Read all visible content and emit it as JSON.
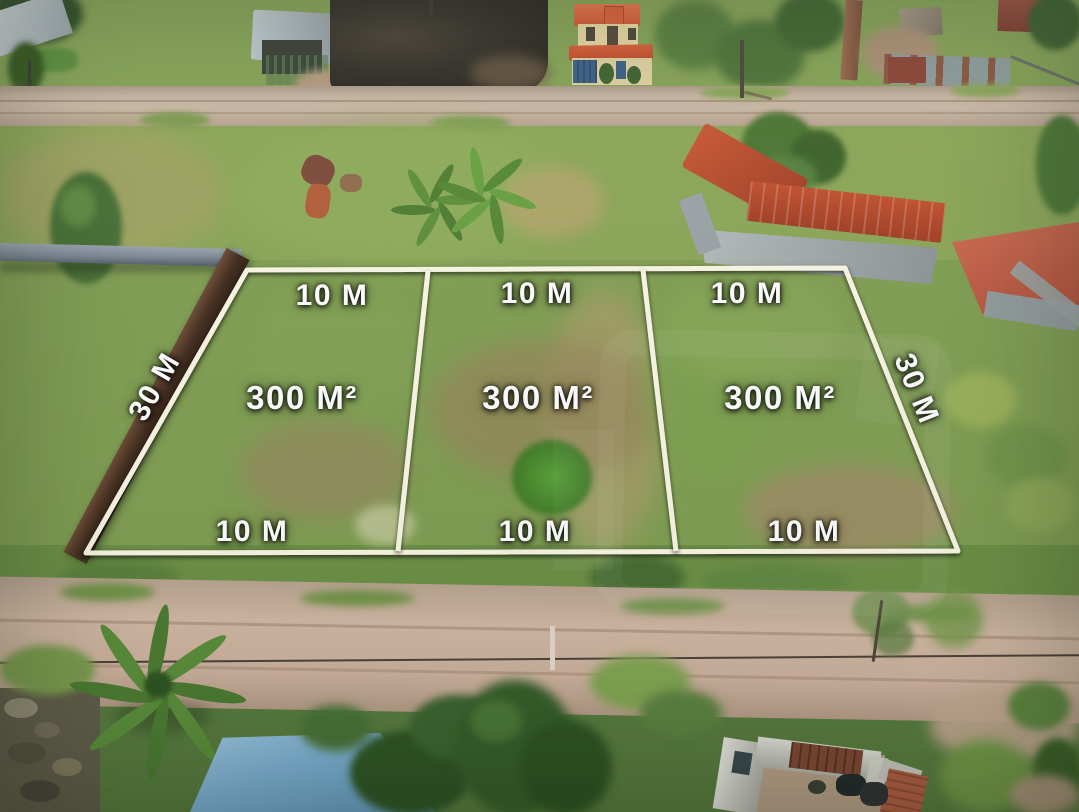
{
  "image_type": "aerial-drone-photo-of-land-plots",
  "overlay": {
    "line_color": "#fbf7e6",
    "label_color": "#ffffff",
    "plots": [
      {
        "top_width": "10 M",
        "area": "300 M²",
        "bottom_width": "10 M"
      },
      {
        "top_width": "10 M",
        "area": "300 M²",
        "bottom_width": "10 M"
      },
      {
        "top_width": "10 M",
        "area": "300 M²",
        "bottom_width": "10 M"
      }
    ],
    "left_side_length": "30 M",
    "right_side_length": "30 M"
  },
  "scene": {
    "description": "Drone aerial view of three marked grass land plots between two dirt roads, surrounded by houses, walls, palms and trees",
    "colors": {
      "grass_green": "#7e9c51",
      "dry_grass": "#a89c68",
      "dirt_road_top": "#c7b4a1",
      "dirt_road_bottom": "#d0b7a3",
      "burnt_ground": "#33302a",
      "tile_roof_orange": "#cf5732",
      "tile_roof_red": "#c25c44",
      "metal_roof_blue": "#7cb0d2",
      "boundary_wall_brown": "#402a1c",
      "white_wall": "#dcdcd4"
    }
  }
}
